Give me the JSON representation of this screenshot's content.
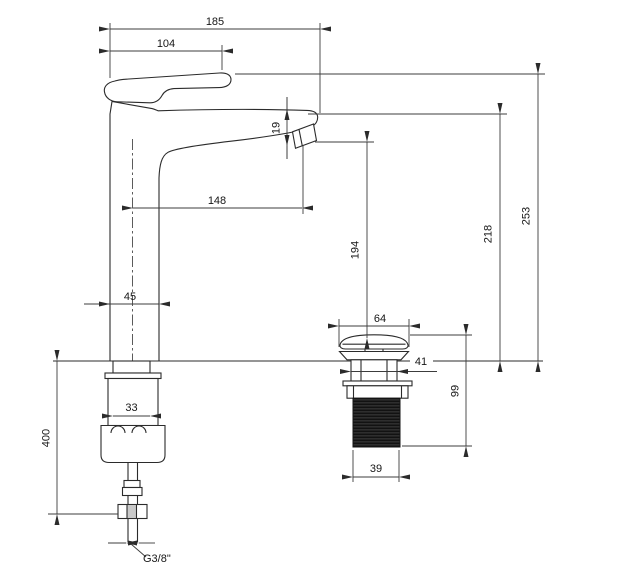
{
  "drawing": {
    "type": "faucet-installation-dimension-drawing",
    "background": "#ffffff",
    "line_color": "#2b2b2b",
    "dimension_color": "#3c3c3c",
    "labels": {
      "total_width": "185",
      "handle_width": "104",
      "spout_outlet_height": "19",
      "spout_reach_from_center": "148",
      "body_depth": "45",
      "base_width": "33",
      "supply_hose_length": "400",
      "supply_thread_size": "G3/8\"",
      "outlet_to_drain_height": "194",
      "spout_top_height": "218",
      "total_height": "253",
      "drain_cap_diameter": "64",
      "drain_neck_diameter": "41",
      "drain_body_height": "99",
      "drain_thread_diameter": "39"
    }
  }
}
